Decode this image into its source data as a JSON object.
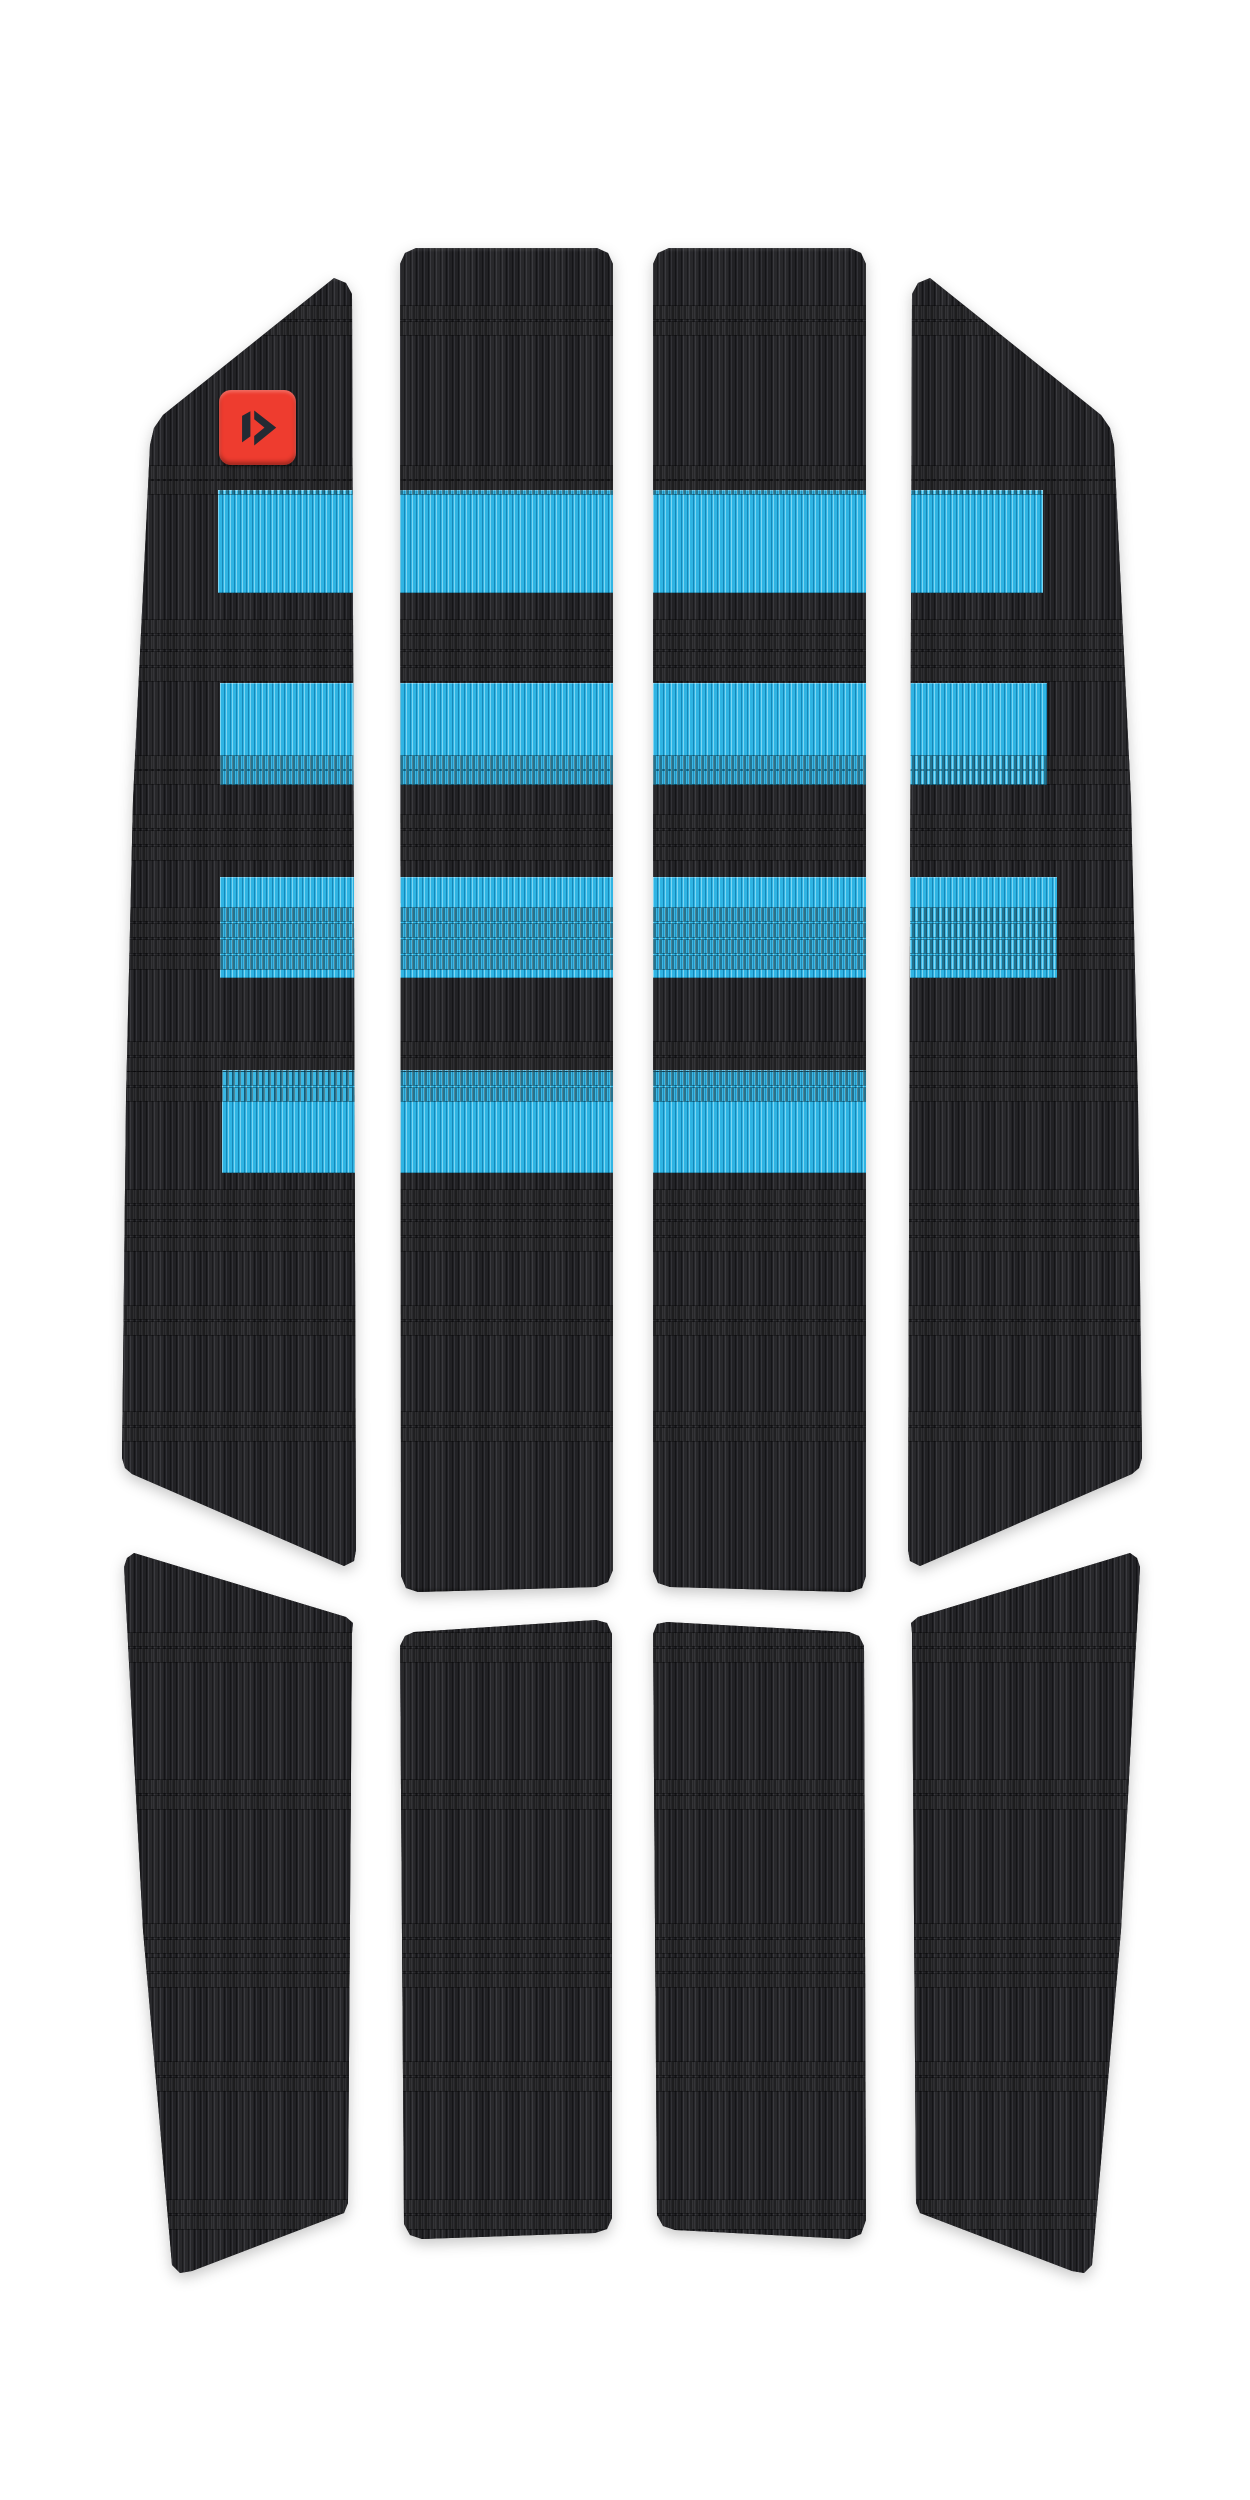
{
  "image": {
    "type": "product-photo",
    "subject": "front traction pad set",
    "brand_mark": "duotone-arrow-icon"
  },
  "colors": {
    "background": "#ffffff",
    "pad_base": "#232326",
    "pad_rib_dark": "#151518",
    "pad_rib_light": "#35353a",
    "stripe_blue": "#2fb4e3",
    "stripe_rib_dark": "#1787b8",
    "stripe_rib_light": "#7dd5f2",
    "logo_red": "#ee3c2f",
    "logo_glyph": "#232a33",
    "shadow": "rgba(0,0,0,0.22)"
  },
  "structure": {
    "upper_pad_count": 4,
    "lower_pad_count": 4,
    "blue_stripe_rows": 4
  }
}
